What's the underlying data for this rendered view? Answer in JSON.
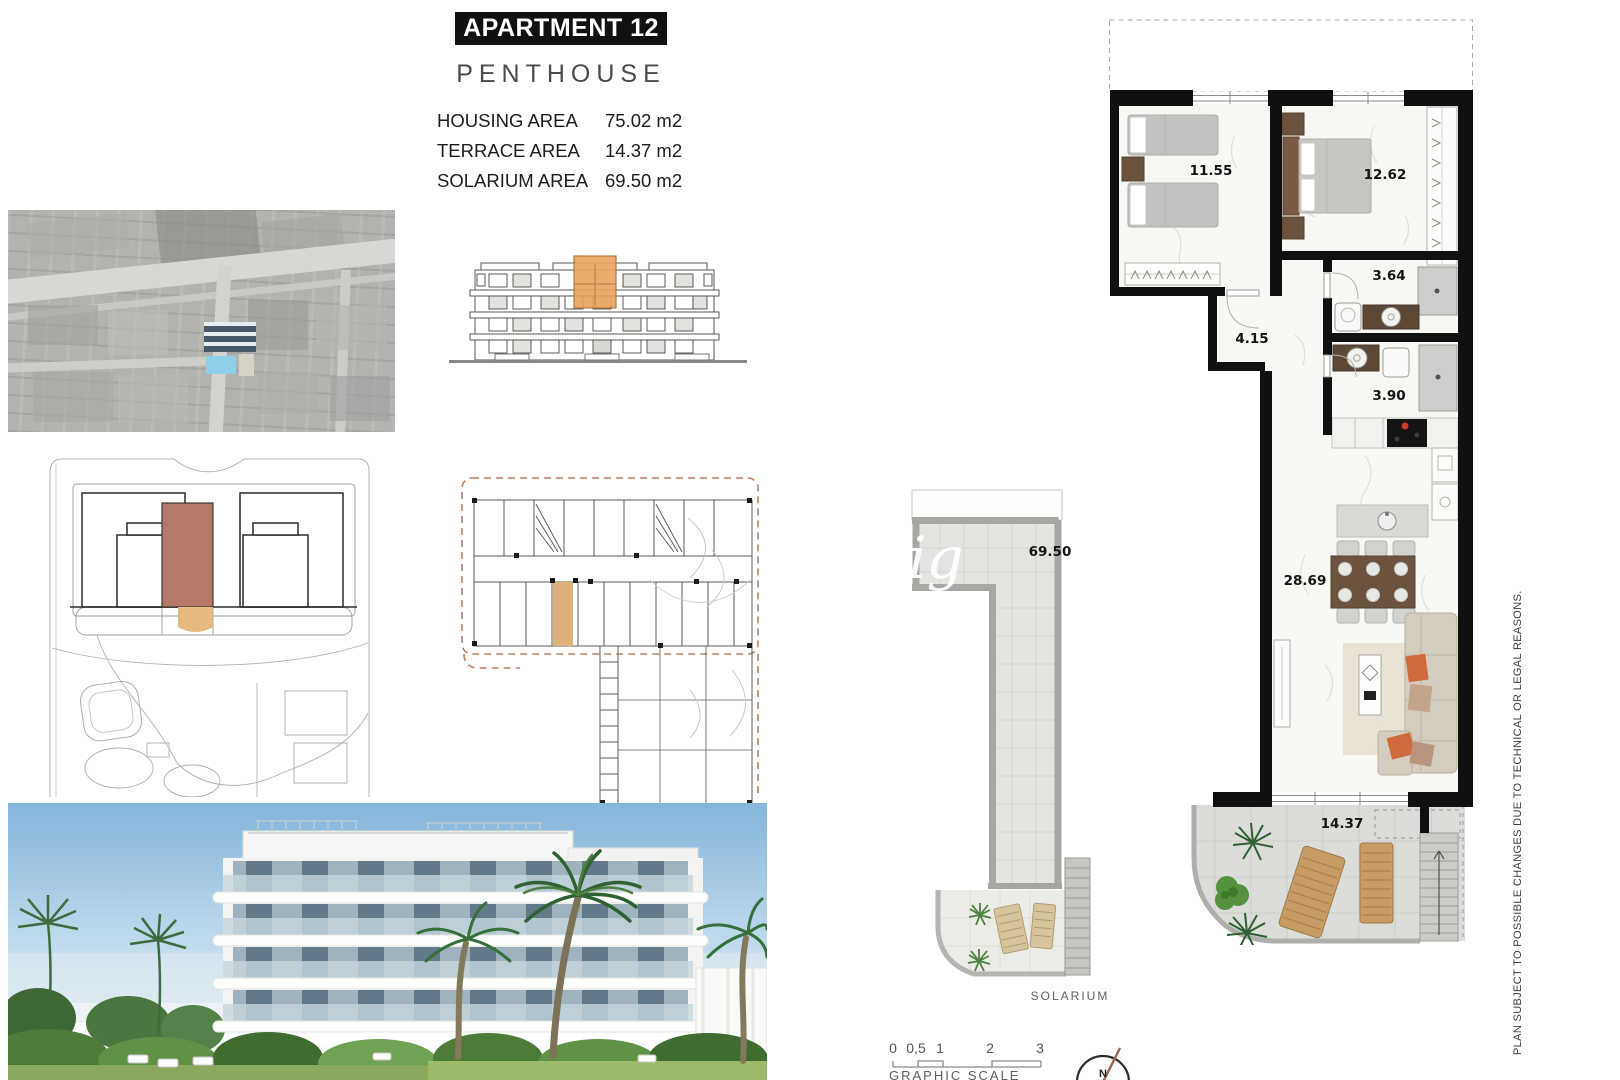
{
  "header": {
    "title": "APARTMENT 12",
    "subtitle": "PENTHOUSE",
    "areas": [
      {
        "label": "HOUSING AREA",
        "value": "75.02 m2"
      },
      {
        "label": "TERRACE AREA",
        "value": "14.37 m2"
      },
      {
        "label": "SOLARIUM AREA",
        "value": "69.50 m2"
      }
    ]
  },
  "main_plan": {
    "rooms": [
      {
        "id": "bedroom-1",
        "area": "11.55"
      },
      {
        "id": "bedroom-2",
        "area": "12.62"
      },
      {
        "id": "bathroom-1",
        "area": "3.64"
      },
      {
        "id": "hallway",
        "area": "4.15"
      },
      {
        "id": "bathroom-2",
        "area": "3.90"
      },
      {
        "id": "living-dining-kitchen",
        "area": "28.69"
      },
      {
        "id": "terrace",
        "area": "14.37"
      }
    ]
  },
  "solarium_plan": {
    "area": "69.50",
    "caption": "SOLARIUM",
    "watermark": "ig"
  },
  "graphic_scale": {
    "ticks": [
      "0",
      "0,5",
      "1",
      "2",
      "3"
    ],
    "caption": "GRAPHIC SCALE"
  },
  "compass": {
    "north_label": "N"
  },
  "disclaimer": "PLAN SUBJECT TO POSSIBLE CHANGES DUE TO TECHNICAL OR LEGAL REASONS.",
  "colors": {
    "wall_black": "#101010",
    "highlight_brick": "#b5786b",
    "highlight_tan": "#e2b27c",
    "highlight_orange": "#eaa55e",
    "wood_lounger": "#c79d66",
    "sofa_pillow_orange": "#cf6a3c",
    "pool_blue": "#8fd0e8",
    "solarium_wall_gray": "#a5a7a2"
  }
}
